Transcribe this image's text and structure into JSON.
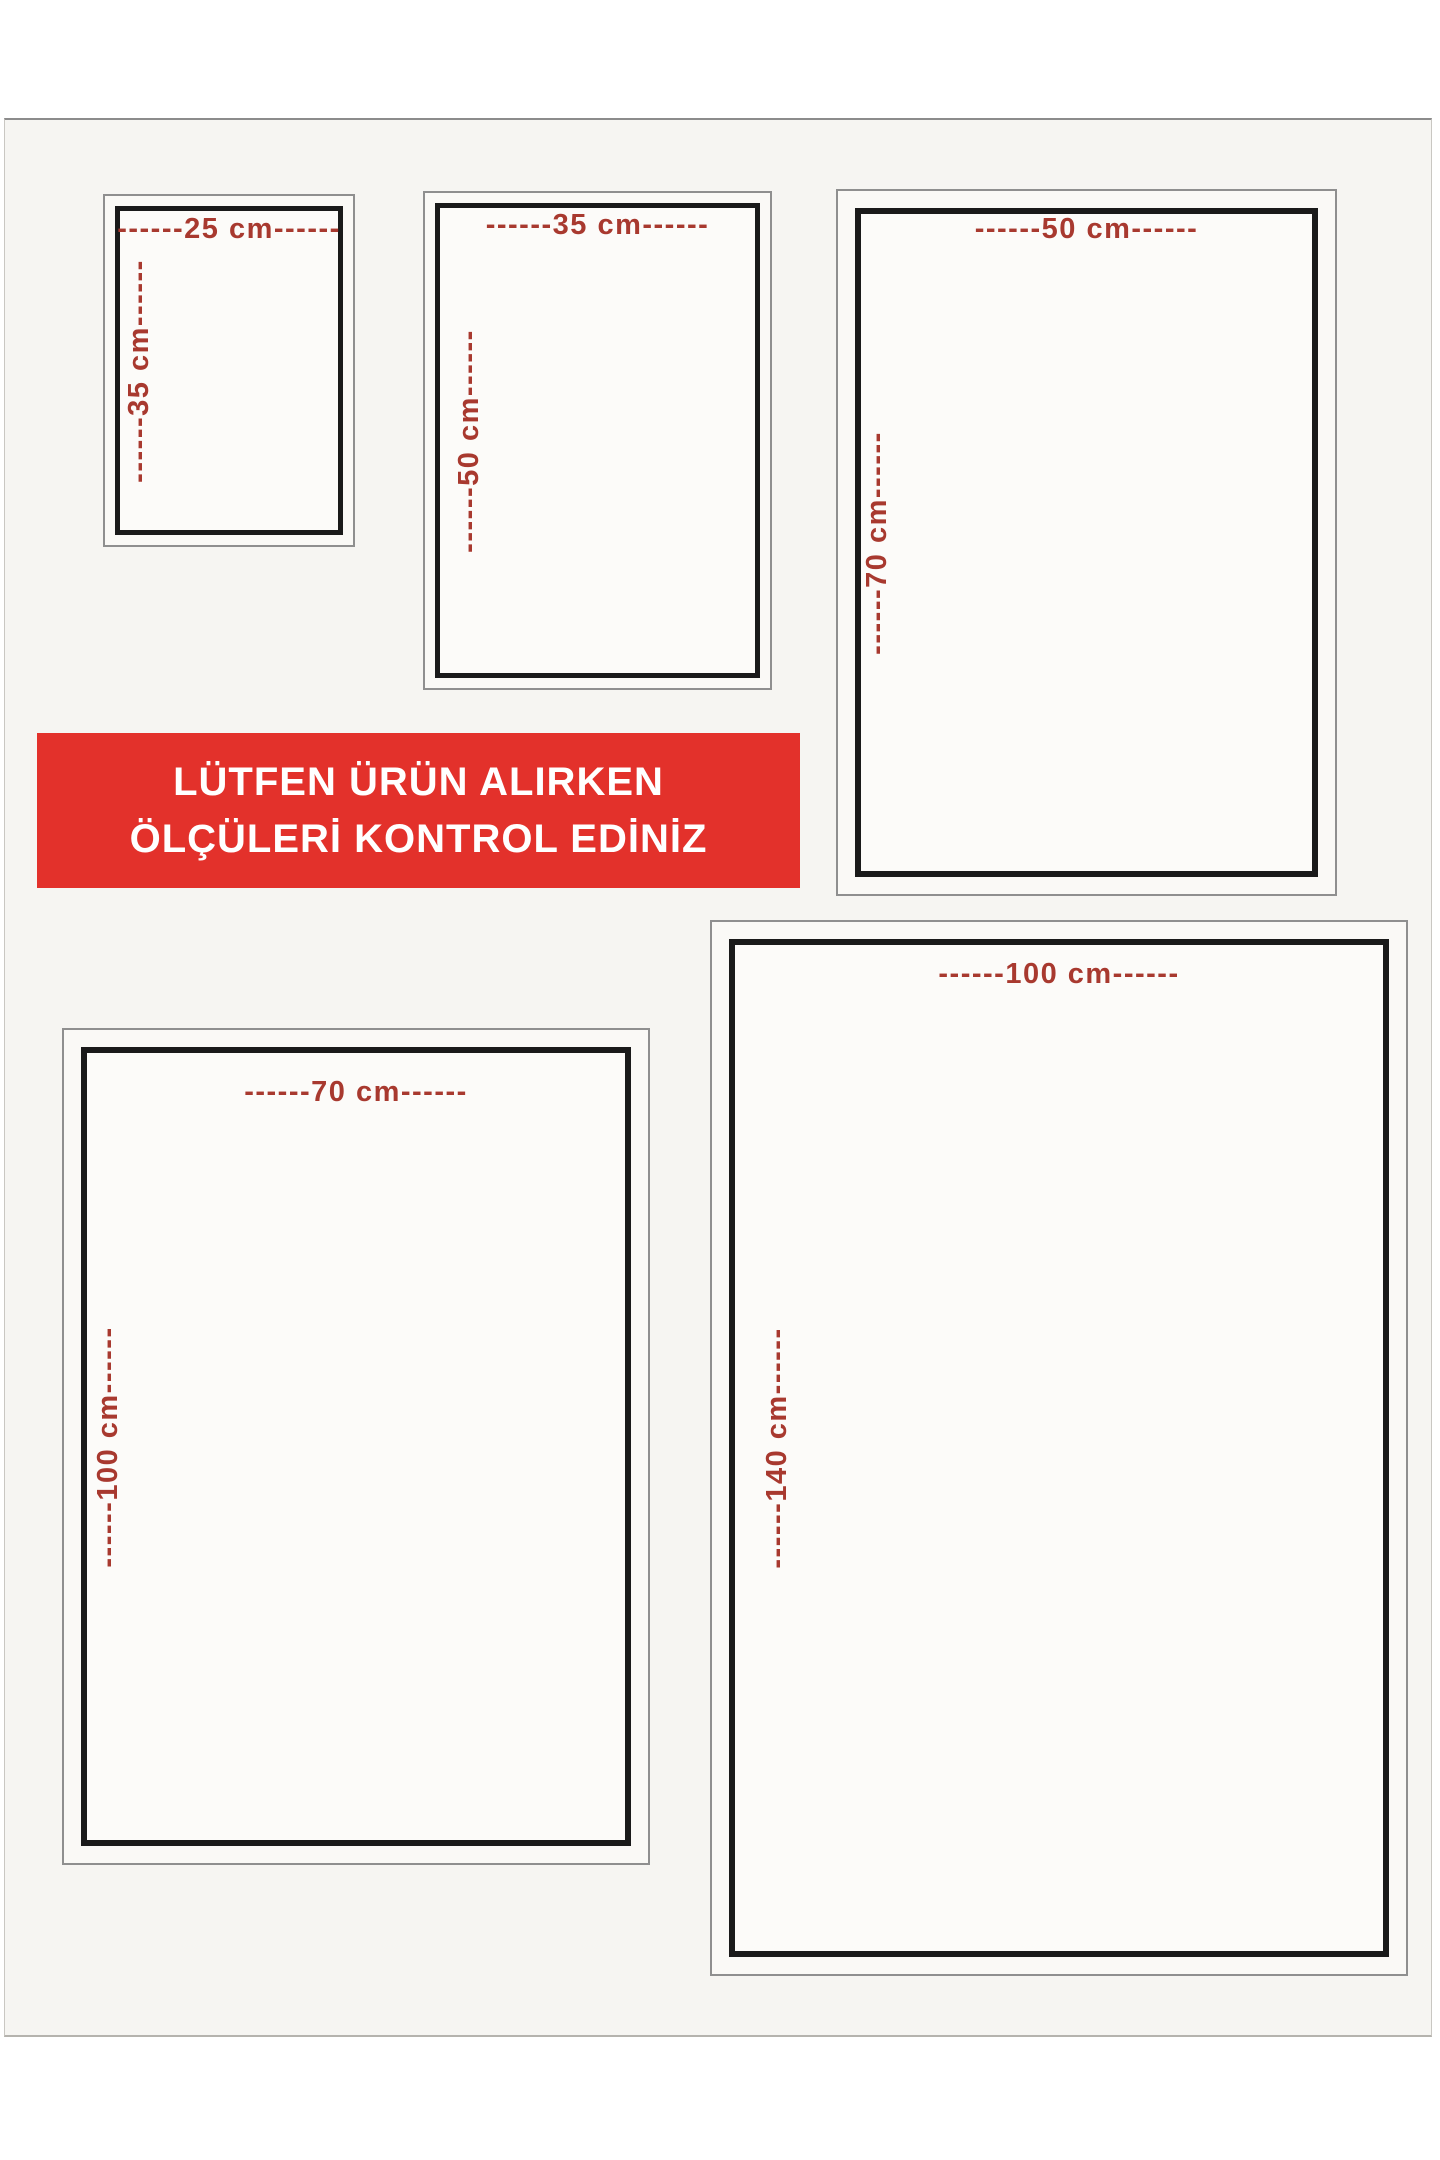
{
  "banner": {
    "line1": "LÜTFEN ÜRÜN ALIRKEN",
    "line2": "ÖLÇÜLERİ KONTROL EDİNİZ"
  },
  "sizes": [
    {
      "id": "25x35",
      "width_cm": 25,
      "height_cm": 35,
      "width_label": "------25 cm------",
      "height_label": "------35 cm------"
    },
    {
      "id": "35x50",
      "width_cm": 35,
      "height_cm": 50,
      "width_label": "------35 cm------",
      "height_label": "------50 cm------"
    },
    {
      "id": "50x70",
      "width_cm": 50,
      "height_cm": 70,
      "width_label": "------50 cm------",
      "height_label": "------70 cm------"
    },
    {
      "id": "70x100",
      "width_cm": 70,
      "height_cm": 100,
      "width_label": "------70 cm------",
      "height_label": "------100 cm------"
    },
    {
      "id": "100x140",
      "width_cm": 100,
      "height_cm": 140,
      "width_label": "------100 cm------",
      "height_label": "------140 cm------"
    }
  ],
  "colors": {
    "banner_bg": "#e3312b",
    "banner_text": "#ffffff",
    "dimension_text": "#a8392f",
    "frame_black": "#1a1a1a",
    "frame_gray": "#8f8f8f",
    "page_bg": "#f6f5f2",
    "box_bg": "#faf9f6",
    "box_inner_bg": "#fcfbf9"
  }
}
